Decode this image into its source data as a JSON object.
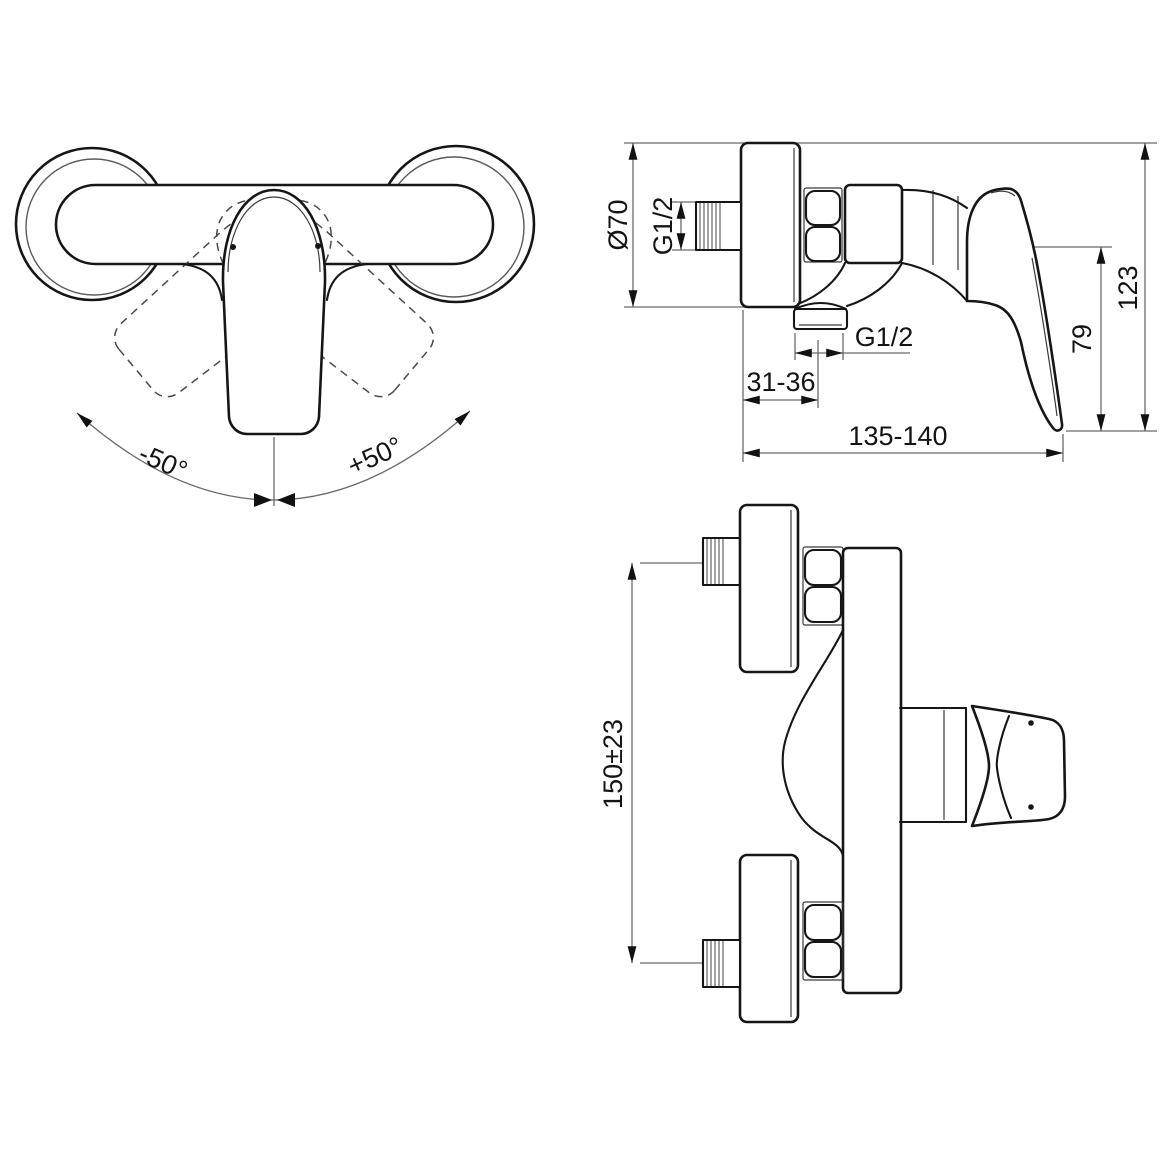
{
  "drawing": {
    "colors": {
      "outline": "#161616",
      "dimension_line": "#6a6a6a",
      "arrowhead": "#111111",
      "text": "#141414",
      "background": "#ffffff"
    },
    "plan_view": {
      "rotation_left": "-50°",
      "rotation_right": "+50°"
    },
    "side_view": {
      "flange_diameter": "Ø70",
      "inlet_thread": "G1/2",
      "outlet_thread": "G1/2",
      "wall_to_outlet_center": "31-36",
      "overall_depth": "135-140",
      "lever_height": "79",
      "overall_height": "123"
    },
    "top_view": {
      "inlet_center_distance": "150±23"
    }
  }
}
